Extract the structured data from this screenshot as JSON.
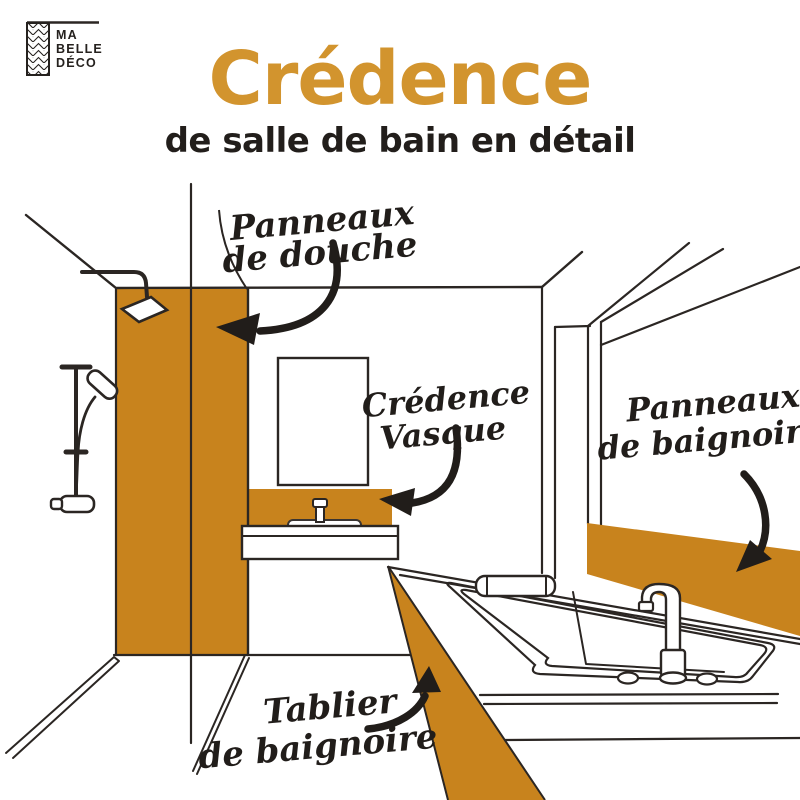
{
  "brand": {
    "line1": "MA",
    "line2": "BELLE",
    "line3": "DÉCO"
  },
  "header": {
    "title": "Crédence",
    "subtitle": "de salle de bain en détail"
  },
  "annotations": {
    "shower_panels": {
      "line1": "Panneaux",
      "line2": "de douche"
    },
    "sink_splashback": {
      "line1": "Crédence",
      "line2": "Vasque"
    },
    "bathtub_panels": {
      "line1": "Panneaux",
      "line2": "de baignoire"
    },
    "bathtub_apron": {
      "line1": "Tablier",
      "line2": "de baignoire"
    }
  },
  "colors": {
    "highlight_orange": "#C8831D",
    "title_orange": "#D2942E",
    "ink": "#2B2623"
  }
}
